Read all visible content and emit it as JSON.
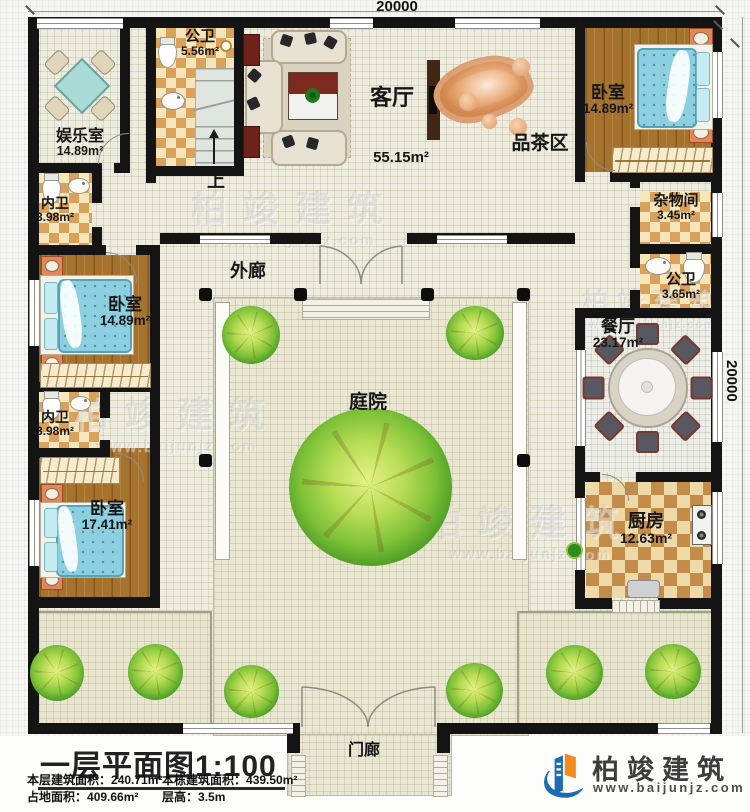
{
  "dimensions": {
    "top": "20000",
    "right": "20000"
  },
  "rooms": {
    "entertainment": {
      "name": "娱乐室",
      "area": "14.89m²"
    },
    "bath_top": {
      "name": "公卫",
      "area": "5.56m²"
    },
    "living": {
      "name": "客厅",
      "area": "55.15m²"
    },
    "tea": {
      "name": "品茶区"
    },
    "bedroom_tr": {
      "name": "卧室",
      "area": "14.89m²"
    },
    "storage": {
      "name": "杂物间",
      "area": "3.45m²"
    },
    "bath_right": {
      "name": "公卫",
      "area": "3.65m²"
    },
    "bath_inner_top": {
      "name": "内卫",
      "area": "3.98m²"
    },
    "bedroom_ml": {
      "name": "卧室",
      "area": "14.89m²"
    },
    "dining": {
      "name": "餐厅",
      "area": "23.17m²"
    },
    "bath_inner_bot": {
      "name": "内卫",
      "area": "3.98m²"
    },
    "bedroom_bl": {
      "name": "卧室",
      "area": "17.41m²"
    },
    "kitchen": {
      "name": "厨房",
      "area": "12.63m²"
    },
    "corridor": {
      "name": "外廊"
    },
    "courtyard": {
      "name": "庭院"
    },
    "porch": {
      "name": "门廊"
    }
  },
  "stairs": {
    "up": "上"
  },
  "footer": {
    "title": "一层平面图",
    "scale": "1:100",
    "stats": {
      "floor_area_label": "本层建筑面积：",
      "floor_area": "240.71m²",
      "building_area_label": "本栋建筑面积：",
      "building_area": "439.50m²",
      "land_area_label": "占地面积：",
      "land_area": "409.66m²",
      "height_label": "层高：",
      "height": "3.5m"
    }
  },
  "brand": {
    "name": "柏竣建筑",
    "url": "www.baijunjz.com"
  },
  "colors": {
    "wall": "#141414",
    "wood": "#a5732e",
    "checker": "#d9a159",
    "bed": "#8ccfe0",
    "tree": "#3f9320",
    "logo_blue": "#1c6cb4",
    "logo_orange": "#f28a1d"
  }
}
